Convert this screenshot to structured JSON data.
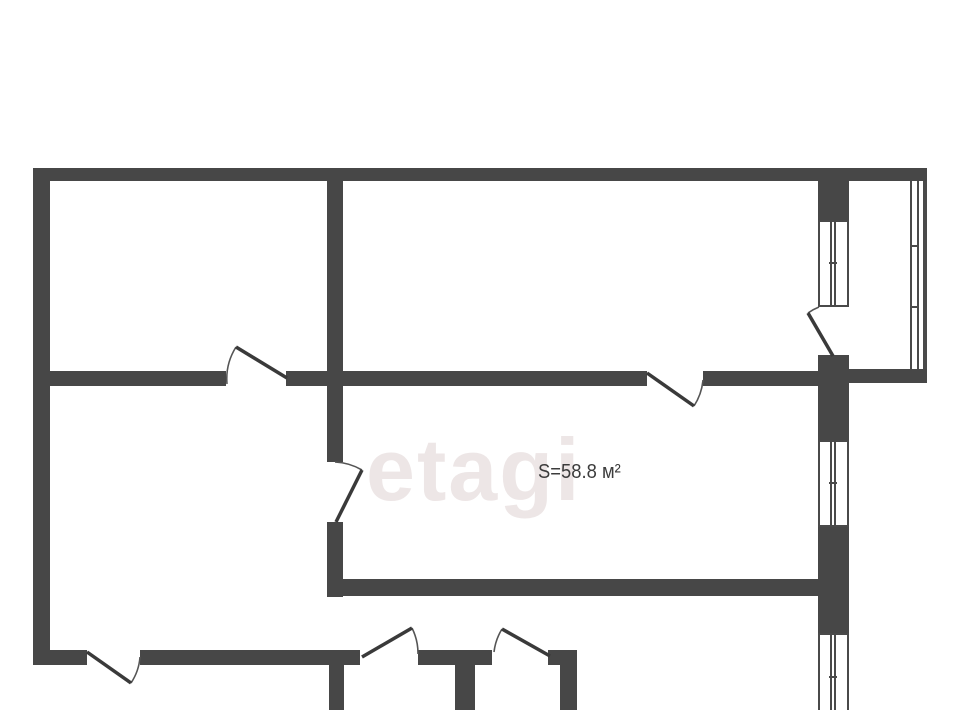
{
  "page": {
    "width": 960,
    "height": 710,
    "background": "#ffffff"
  },
  "watermark": {
    "text": "etagi"
  },
  "area_label": {
    "text": "S=58.8 м²"
  },
  "colors": {
    "wall": "#474747",
    "thin_line": "#4a4a4a",
    "door_leaf": "#3a3a3a",
    "door_arc": "#555555",
    "watermark": "#ede6e6",
    "label": "#3c3c3c"
  },
  "floorplan": {
    "walls": [
      {
        "x": 33,
        "y": 168,
        "w": 894,
        "h": 13
      },
      {
        "x": 33,
        "y": 181,
        "w": 17,
        "h": 484
      },
      {
        "x": 50,
        "y": 371,
        "w": 176,
        "h": 15
      },
      {
        "x": 286,
        "y": 371,
        "w": 361,
        "h": 15
      },
      {
        "x": 703,
        "y": 371,
        "w": 115,
        "h": 15
      },
      {
        "x": 846,
        "y": 369,
        "w": 81,
        "h": 14
      },
      {
        "x": 327,
        "y": 181,
        "w": 16,
        "h": 281
      },
      {
        "x": 327,
        "y": 522,
        "w": 16,
        "h": 75
      },
      {
        "x": 327,
        "y": 579,
        "w": 491,
        "h": 17
      },
      {
        "x": 50,
        "y": 650,
        "w": 37,
        "h": 15
      },
      {
        "x": 140,
        "y": 650,
        "w": 220,
        "h": 15
      },
      {
        "x": 418,
        "y": 650,
        "w": 74,
        "h": 15
      },
      {
        "x": 548,
        "y": 650,
        "w": 29,
        "h": 15
      },
      {
        "x": 329,
        "y": 665,
        "w": 15,
        "h": 45
      },
      {
        "x": 455,
        "y": 665,
        "w": 20,
        "h": 45
      },
      {
        "x": 560,
        "y": 665,
        "w": 17,
        "h": 45
      },
      {
        "x": 818,
        "y": 181,
        "w": 31,
        "h": 39
      },
      {
        "x": 818,
        "y": 355,
        "w": 31,
        "h": 85
      },
      {
        "x": 818,
        "y": 527,
        "w": 31,
        "h": 106
      }
    ],
    "window_lines": [
      {
        "x": 818,
        "y": 220,
        "w": 2,
        "h": 87
      },
      {
        "x": 847,
        "y": 220,
        "w": 2,
        "h": 87
      },
      {
        "x": 830,
        "y": 220,
        "w": 2,
        "h": 87
      },
      {
        "x": 834,
        "y": 220,
        "w": 2,
        "h": 87
      },
      {
        "x": 818,
        "y": 220,
        "w": 31,
        "h": 2
      },
      {
        "x": 818,
        "y": 305,
        "w": 31,
        "h": 2
      },
      {
        "x": 829,
        "y": 262,
        "w": 8,
        "h": 2
      },
      {
        "x": 818,
        "y": 440,
        "w": 2,
        "h": 87
      },
      {
        "x": 847,
        "y": 440,
        "w": 2,
        "h": 87
      },
      {
        "x": 830,
        "y": 440,
        "w": 2,
        "h": 87
      },
      {
        "x": 834,
        "y": 440,
        "w": 2,
        "h": 87
      },
      {
        "x": 818,
        "y": 440,
        "w": 31,
        "h": 2
      },
      {
        "x": 818,
        "y": 525,
        "w": 31,
        "h": 2
      },
      {
        "x": 829,
        "y": 482,
        "w": 8,
        "h": 2
      },
      {
        "x": 818,
        "y": 633,
        "w": 2,
        "h": 77
      },
      {
        "x": 847,
        "y": 633,
        "w": 2,
        "h": 77
      },
      {
        "x": 830,
        "y": 633,
        "w": 2,
        "h": 77
      },
      {
        "x": 834,
        "y": 633,
        "w": 2,
        "h": 77
      },
      {
        "x": 818,
        "y": 633,
        "w": 31,
        "h": 2
      },
      {
        "x": 829,
        "y": 676,
        "w": 8,
        "h": 2
      },
      {
        "x": 910,
        "y": 181,
        "w": 2,
        "h": 188
      },
      {
        "x": 917,
        "y": 181,
        "w": 2,
        "h": 188
      },
      {
        "x": 923,
        "y": 181,
        "w": 4,
        "h": 188
      },
      {
        "x": 910,
        "y": 245,
        "w": 9,
        "h": 2
      },
      {
        "x": 910,
        "y": 306,
        "w": 9,
        "h": 2
      }
    ],
    "doors": [
      {
        "leaf": [
          287,
          378,
          236,
          347
        ],
        "arc": "M 236 347 A 60 60 0 0 0 227 384"
      },
      {
        "leaf": [
          647,
          373,
          694,
          406
        ],
        "arc": "M 694 406 A 57 57 0 0 0 703 380"
      },
      {
        "leaf": [
          87,
          652,
          131,
          683
        ],
        "arc": "M 131 683 A 54 54 0 0 0 140 657"
      },
      {
        "leaf": [
          362,
          657,
          412,
          628
        ],
        "arc": "M 412 628 A 57 57 0 0 1 418 654"
      },
      {
        "leaf": [
          550,
          656,
          502,
          629
        ],
        "arc": "M 502 629 A 56 56 0 0 0 494 652"
      },
      {
        "leaf": [
          336,
          522,
          362,
          470
        ],
        "arc": "M 362 470 A 59 59 0 0 0 335 462"
      },
      {
        "leaf": [
          833,
          356,
          808,
          313
        ],
        "arc": "M 808 313 A 51 51 0 0 1 819 307"
      }
    ]
  }
}
